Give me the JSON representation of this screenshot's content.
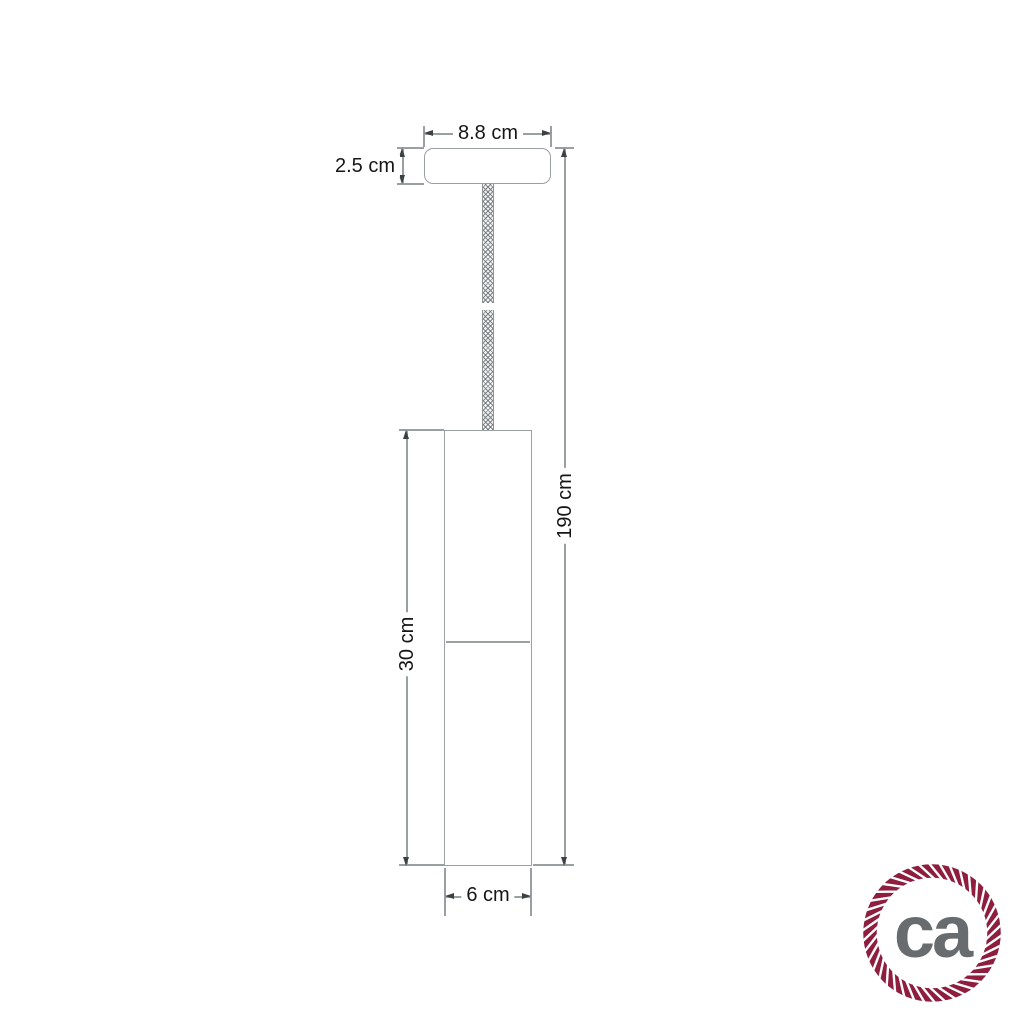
{
  "colors": {
    "background": "#ffffff",
    "line": "#9aa0a2",
    "arrow": "#3c4143",
    "text": "#161616",
    "rope_maroon": "#8e1d3e",
    "logo_gray": "#696c6e",
    "cable_gray": "#8f9597"
  },
  "diagram": {
    "type": "pendant-lamp-dimension-drawing",
    "labels": {
      "canopy_width": "8.8 cm",
      "canopy_height": "2.5 cm",
      "total_drop": "190 cm",
      "shade_height": "30 cm",
      "shade_diameter": "6 cm"
    }
  },
  "logo": {
    "text": "ca"
  }
}
